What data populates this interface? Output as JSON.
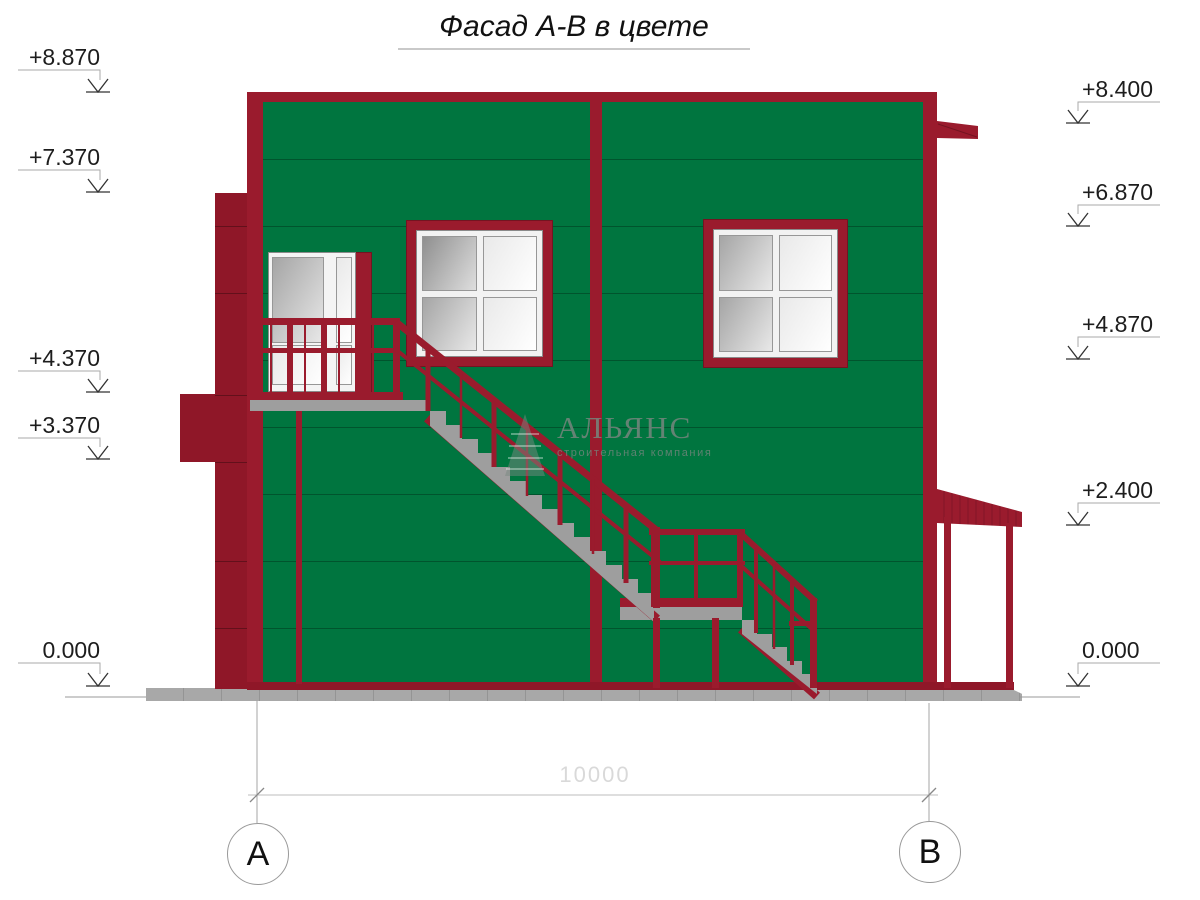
{
  "title": {
    "text": "Фасад А-В в цвете"
  },
  "levels": {
    "left": [
      {
        "value": "+8.870"
      },
      {
        "value": "+7.370"
      },
      {
        "value": "+4.370"
      },
      {
        "value": "+3.370"
      },
      {
        "value": "0.000"
      }
    ],
    "right": [
      {
        "value": "+8.400"
      },
      {
        "value": "+6.870"
      },
      {
        "value": "+4.870"
      },
      {
        "value": "+2.400"
      },
      {
        "value": "0.000"
      }
    ]
  },
  "axes": {
    "left_label": "А",
    "right_label": "В",
    "dimension": "10000"
  },
  "watermark": {
    "name": "АЛЬЯНС",
    "subtitle": "строительная компания"
  },
  "colors": {
    "facade_green": "#00753F",
    "trim_red": "#9A1B2D",
    "trim_red_dark": "#8F1728",
    "concrete": "#9E9E9E",
    "pavement": "#A8A8A8"
  }
}
